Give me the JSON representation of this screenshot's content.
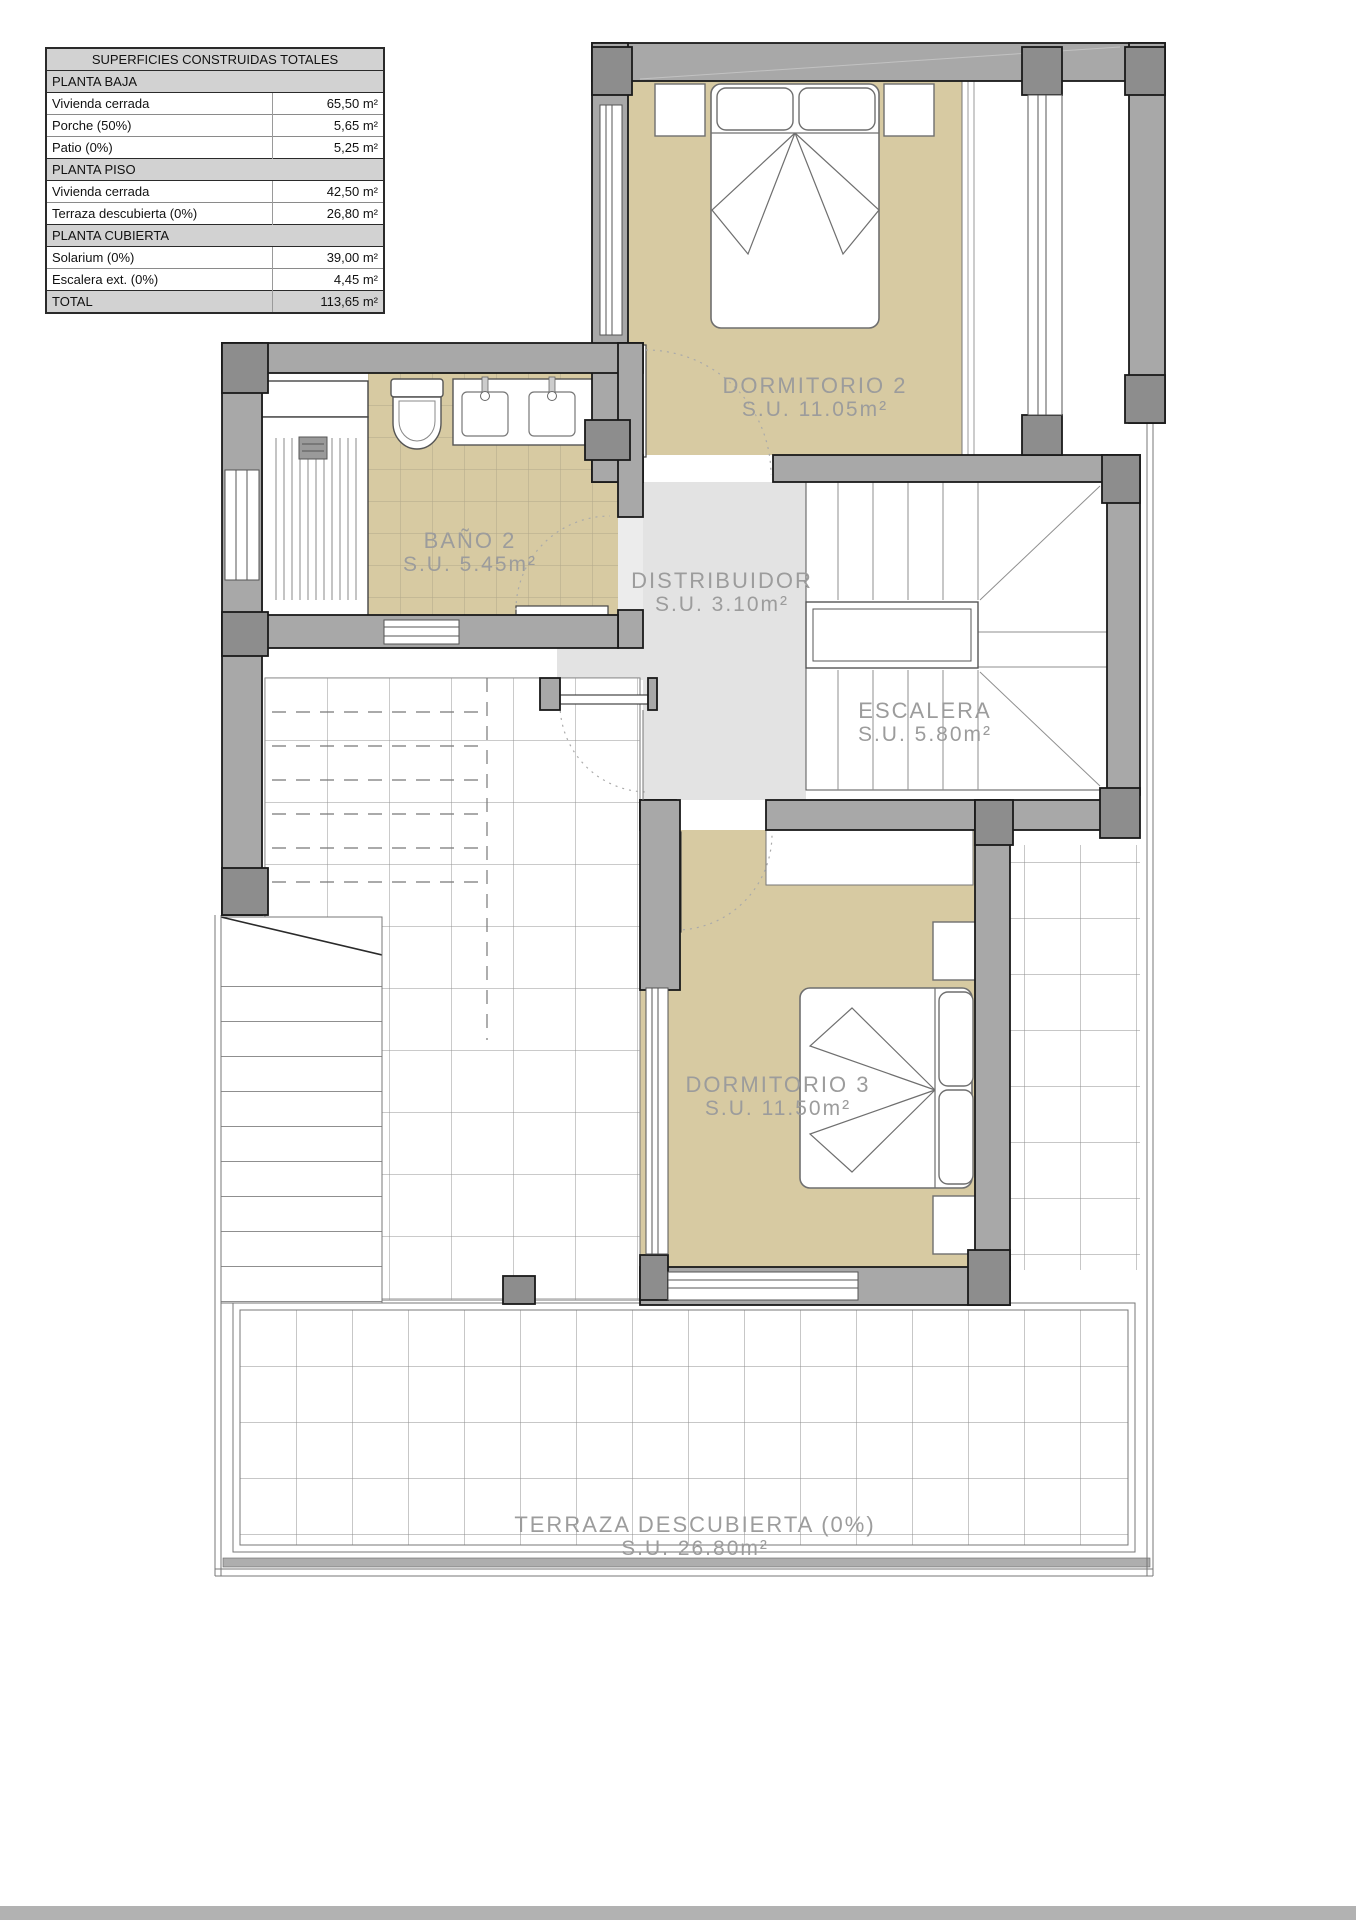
{
  "table": {
    "title": "SUPERFICIES CONSTRUIDAS TOTALES",
    "rows": [
      {
        "label": "PLANTA BAJA",
        "value": "",
        "type": "section"
      },
      {
        "label": "Vivienda cerrada",
        "value": "65,50 m²",
        "type": "data"
      },
      {
        "label": "Porche (50%)",
        "value": "5,65 m²",
        "type": "data"
      },
      {
        "label": "Patio (0%)",
        "value": "5,25 m²",
        "type": "data"
      },
      {
        "label": "PLANTA PISO",
        "value": "",
        "type": "section"
      },
      {
        "label": "Vivienda cerrada",
        "value": "42,50 m²",
        "type": "data"
      },
      {
        "label": "Terraza descubierta (0%)",
        "value": "26,80 m²",
        "type": "data"
      },
      {
        "label": "PLANTA CUBIERTA",
        "value": "",
        "type": "section"
      },
      {
        "label": "Solarium (0%)",
        "value": "39,00 m²",
        "type": "data"
      },
      {
        "label": "Escalera ext. (0%)",
        "value": "4,45 m²",
        "type": "data"
      },
      {
        "label": "TOTAL",
        "value": "113,65 m²",
        "type": "total"
      }
    ]
  },
  "plan": {
    "rooms": [
      {
        "name": "DORMITORIO 2",
        "area": "S.U. 11.05m²"
      },
      {
        "name": "BAÑO 2",
        "area": "S.U. 5.45m²"
      },
      {
        "name": "DISTRIBUIDOR",
        "area": "S.U. 3.10m²"
      },
      {
        "name": "ESCALERA",
        "area": "S.U. 5.80m²"
      },
      {
        "name": "DORMITORIO 3",
        "area": "S.U. 11.50m²"
      },
      {
        "name": "TERRAZA DESCUBIERTA (0%)",
        "area": "S.U. 26.80m²"
      }
    ],
    "colors": {
      "floor_beige": "#d7caa2",
      "wall_gray": "#a8a8a8",
      "column_gray": "#8d8d8d",
      "hall_gray": "#e3e3e3",
      "label_gray": "#9c9c9c"
    }
  }
}
